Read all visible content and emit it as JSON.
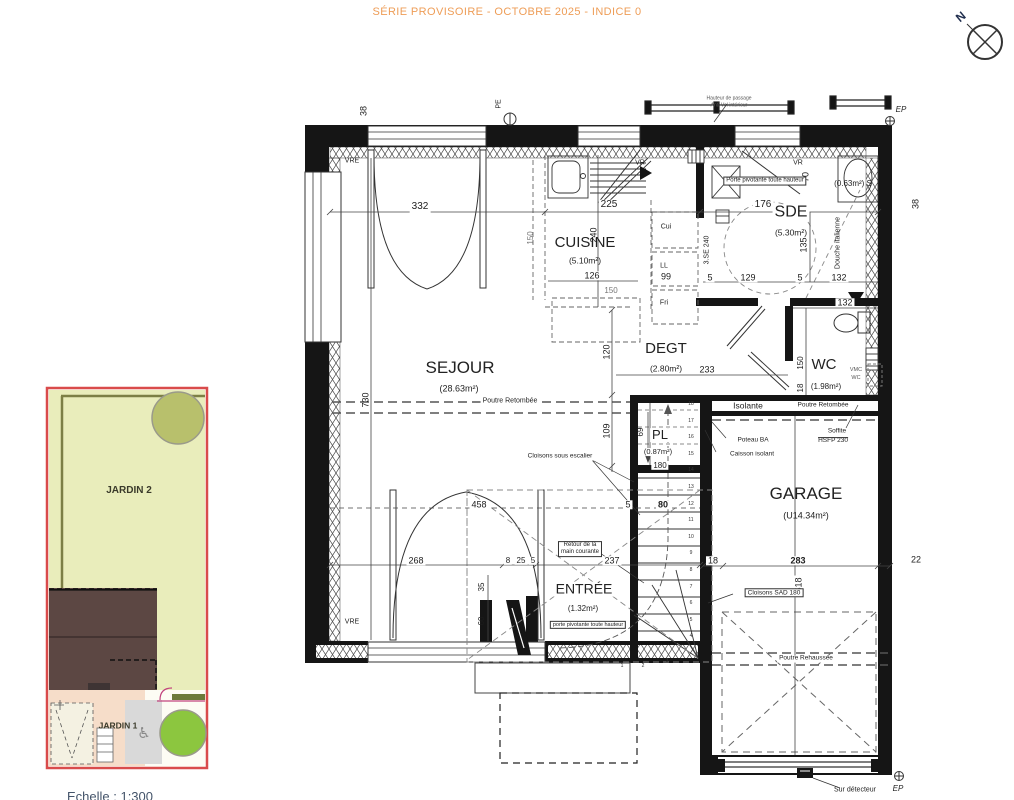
{
  "header": {
    "title": "SÉRIE PROVISOIRE - OCTOBRE 2025 - INDICE 0"
  },
  "compass": {
    "north": "N"
  },
  "rooms": {
    "sejour": {
      "name": "SEJOUR",
      "area": "(28.63m²)"
    },
    "cuisine": {
      "name": "CUISINE",
      "area": "(5.10m²)"
    },
    "sde": {
      "name": "SDE",
      "area": "(5.30m²)"
    },
    "degt": {
      "name": "DEGT",
      "area": "(2.80m²)"
    },
    "wc": {
      "name": "WC",
      "area": "(1.98m²)"
    },
    "pl": {
      "name": "PL",
      "area": "(0.87m²)"
    },
    "garage": {
      "name": "GARAGE",
      "area": "(U14.34m²)"
    },
    "entree": {
      "name": "ENTRÉE",
      "area": "(1.32m²)"
    },
    "placard_s": {
      "label": "(0.63m²) S"
    }
  },
  "annotations": {
    "vre": "VRE",
    "vr": "VR",
    "pe": "PE",
    "ep": "EP",
    "cui": "Cui",
    "ll": "LL",
    "fri": "Fri",
    "sse": "3.SE 240",
    "porte_pivotante": "Porte pivotante toute hauteur",
    "porte_pivotante_entree": "porte pivotante toute hauteur",
    "douche_italienne": "Douche italienne",
    "vmc_line1": "VMC",
    "vmc_line2": "WC",
    "poutre_retombee": "Poutre Retombée",
    "poutre_rehaussee": "Poutre Rehaussée",
    "isolante": "Isolante",
    "poteau_ba": "Poteau BA",
    "caisson_isolant": "Caisson isolant",
    "soffite_line1": "Soffite",
    "soffite_line2": "HSFP 230",
    "cloisons_sad": "Cloisons SAD 180",
    "cloisons_escalier": "Cloisons sous escalier",
    "retour_line1": "Retour de la",
    "retour_line2": "main courante",
    "sur_detecteur": "Sur détecteur",
    "passage_line1": "Hauteur de passage",
    "passage_line2": "Anti-Vol intérieur"
  },
  "dimensions": {
    "d5": "5",
    "d8": "8",
    "d18": "18",
    "d22": "22",
    "d25": "25",
    "d35": "35",
    "d38": "38",
    "d60": "60",
    "d69": "69",
    "d70": "70",
    "d80": "80",
    "d99": "99",
    "d109": "109",
    "d120": "120",
    "d126": "126",
    "d129": "129",
    "d132": "132",
    "d135": "135",
    "d150": "150",
    "d176": "176",
    "d180": "180",
    "d225": "225",
    "d233": "233",
    "d237": "237",
    "d240": "240",
    "d268": "268",
    "d283": "283",
    "d332": "332",
    "d458": "458",
    "d518": "518",
    "d730": "730"
  },
  "stairs": {
    "numbers": [
      "18",
      "17",
      "16",
      "15",
      "14",
      "13",
      "12",
      "11",
      "10",
      "9",
      "8",
      "7",
      "6",
      "5",
      "4"
    ],
    "winders": [
      "1",
      "2",
      "3"
    ]
  },
  "site_plan": {
    "jardin2": "JARDIN 2",
    "jardin1": "JARDIN 1",
    "scale": "Echelle : 1:300",
    "colors": {
      "border": "#d94b4b",
      "lawn": "#e9edbb",
      "hedge": "#7c7f45",
      "tree_olive": "#b8c06c",
      "tree_green": "#8cc63f",
      "building": "#5c4743",
      "path": "#f6ddc9",
      "pavement": "#d9d9d9"
    }
  },
  "colors": {
    "header": "#ee9d57",
    "wall": "#151515",
    "line": "#333333",
    "scale_text": "#44546a"
  }
}
